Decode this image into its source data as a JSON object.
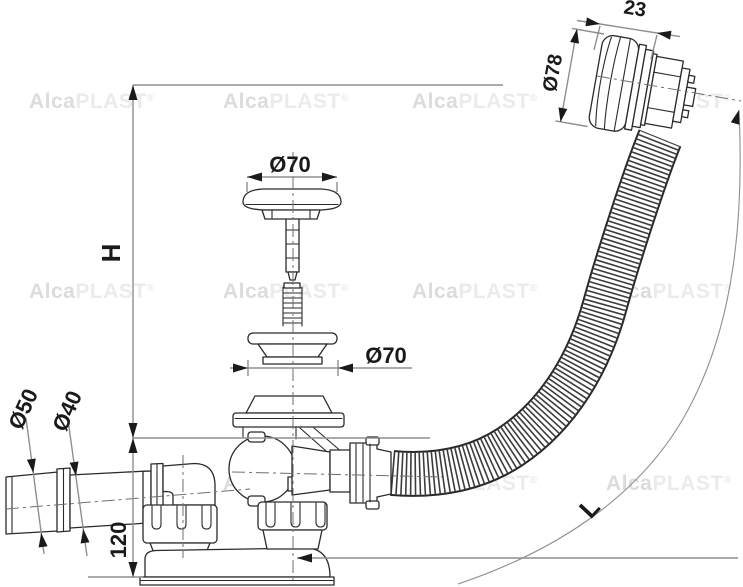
{
  "drawing": {
    "type": "technical-diagram",
    "subject": "bath waste and overflow drain set, side view with exploded plug parts",
    "watermark": {
      "brand_bold": "Alca",
      "brand_light": "PLAST",
      "registered": "®"
    },
    "dimensions": {
      "overall_height_label": "H",
      "hose_length_label": "L",
      "knob_width": "23",
      "knob_diameter": "Ø78",
      "plug_cap_diameter": "Ø70",
      "seat_flange_diameter": "Ø70",
      "outlet_pipe_outer_diameter": "Ø50",
      "outlet_pipe_inner_diameter": "Ø40",
      "drain_body_height": "120"
    },
    "colors": {
      "background": "#ffffff",
      "part_outline": "#2a2a2a",
      "dimension_line": "#8f8f8f",
      "dimension_text": "#1a1a1a",
      "centerline": "#6f6f6f",
      "watermark_bold": "#dcdcdc",
      "watermark_light": "#ebebeb"
    }
  }
}
